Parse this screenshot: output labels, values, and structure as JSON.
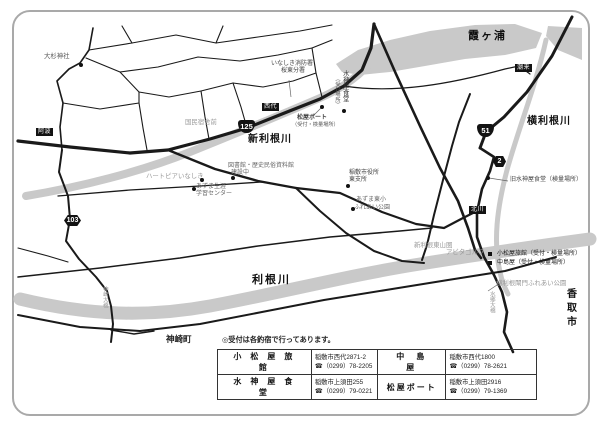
{
  "map": {
    "waters": {
      "kasumigaura": "霞ヶ浦",
      "yokotone": "横利根川",
      "shintone": "新利根川",
      "tone": "利根川"
    },
    "places": {
      "kozaki_town": "神崎町",
      "katori_city": "香取市"
    },
    "route_shields": {
      "r125": "125",
      "r51": "51",
      "pref2": "2",
      "pref103": "103"
    },
    "road_tags": {
      "aba": "阿波",
      "nishishiro": "西代",
      "itako": "潮来",
      "kitagawa": "北川"
    },
    "bridges": {
      "kozaki": "神崎大橋",
      "suigo": "水郷大橋"
    },
    "pois": {
      "osugi_shrine": "大杉神社",
      "fire_station_1": "いなしき消防署",
      "fire_station_2": "桜東分署",
      "suijinya_vertical": "水神屋食堂",
      "suijinya_note": "（受付場所）",
      "matsuya_boat": "松屋ボート",
      "matsuya_boat_note": "（受付・検量場所）",
      "kokumin": "国民宿舎前",
      "heartpia": "ハートピアいなしき",
      "azuma_center_1": "あずま生涯",
      "azuma_center_2": "学習センター",
      "library_1": "図書館・歴史民俗資料館",
      "library_2": "建設中",
      "city_office_1": "稲敷市役所",
      "city_office_2": "東支所",
      "azuma_school_1": "あずま東小",
      "azuma_school_2": "ふれあい公園",
      "kyu_suijinya": "旧水神屋食堂（検量場所）",
      "komatsuya": "小松屋旅館（受付・検量場所）",
      "nakajimaya": "中島屋（受付・検量場所）",
      "higashiyama": "新利根東山圏",
      "golf": "アビタゴルフ",
      "lock_park": "横利根閘門ふれあい公園"
    }
  },
  "table": {
    "note": "◎受付は各釣宿で行ってあります。",
    "rows": [
      {
        "name1": "小松屋旅館",
        "addr1": "稲敷市西代2871-2",
        "tel1": "☎（0299）78-2205",
        "name2": "中島屋",
        "addr2": "稲敷市西代1800",
        "tel2": "☎（0299）78-2621"
      },
      {
        "name1": "水神屋食堂",
        "addr1": "稲敷市上須田255",
        "tel1": "☎（0299）79-0221",
        "name2": "松屋ボート",
        "addr2": "稲敷市上須田2916",
        "tel2": "☎（0299）79-1369"
      }
    ]
  },
  "colors": {
    "river": "#c9c9c9",
    "road": "#1a1a1a",
    "frame": "#a9a9a9"
  }
}
